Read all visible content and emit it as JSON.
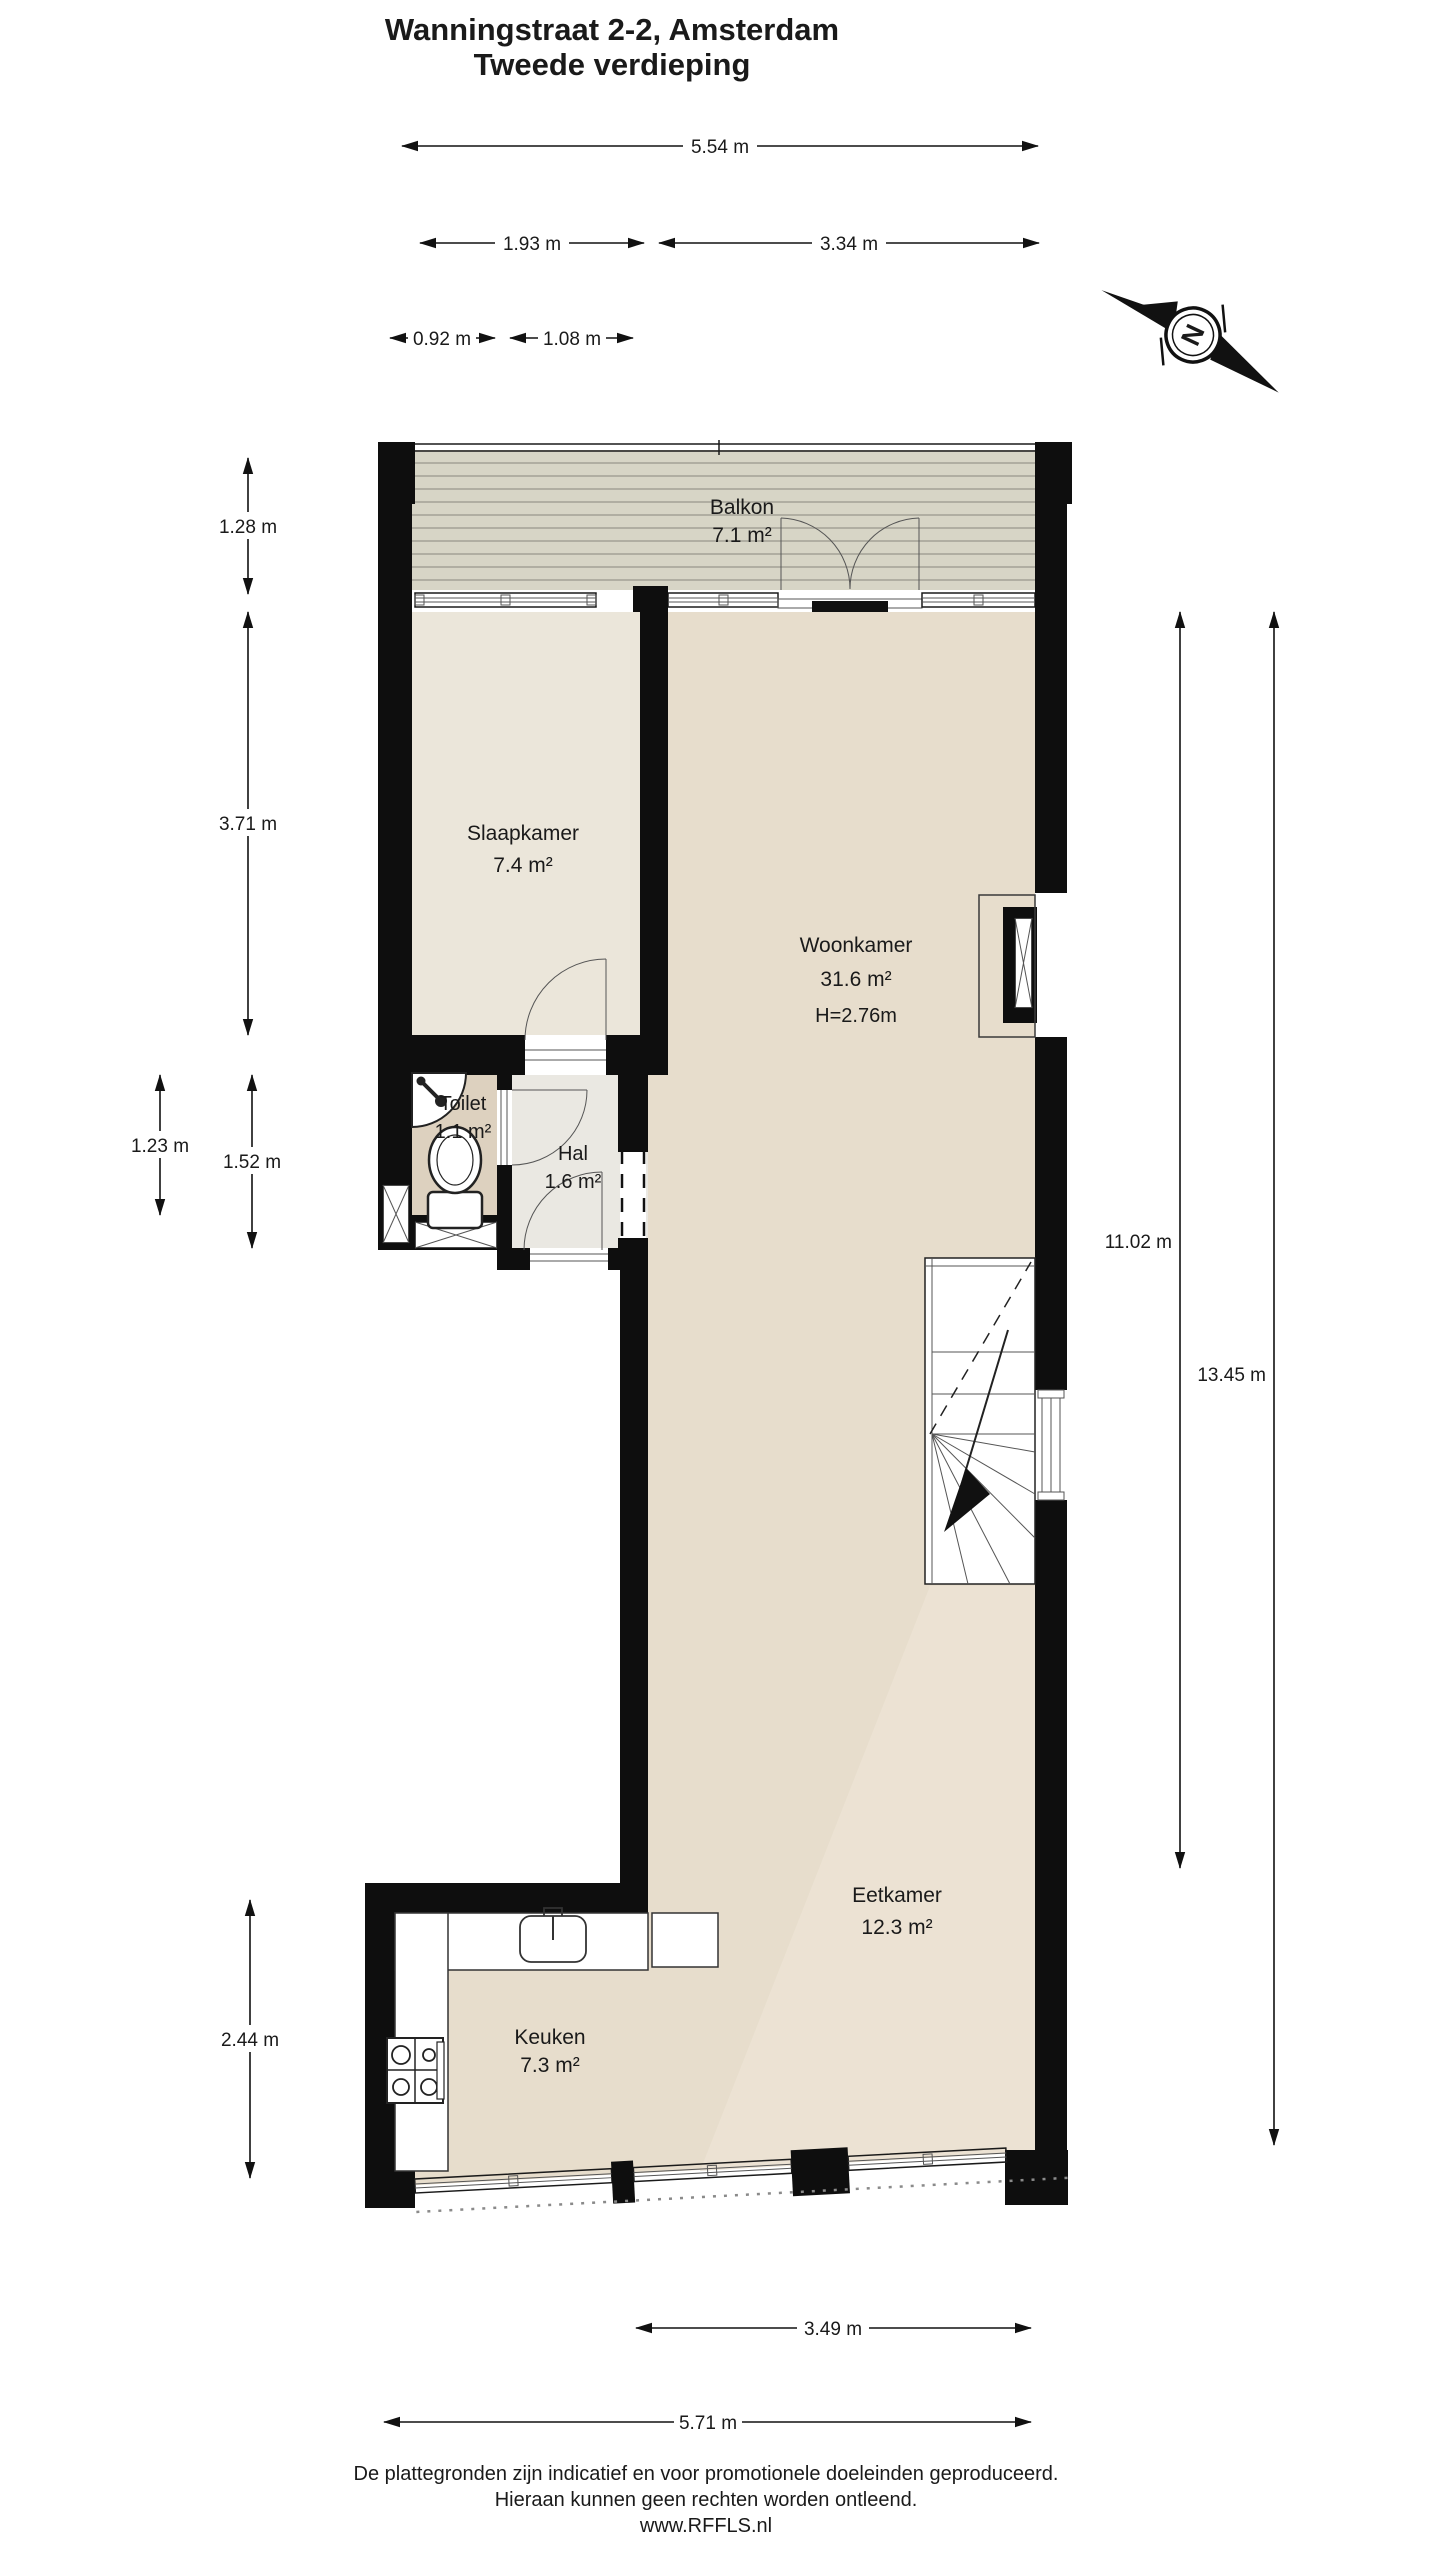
{
  "title": {
    "line1": "Wanningstraat 2-2, Amsterdam",
    "line2": "Tweede verdieping"
  },
  "rooms": {
    "balkon": {
      "name": "Balkon",
      "area": "7.1 m²"
    },
    "slaapkamer": {
      "name": "Slaapkamer",
      "area": "7.4 m²"
    },
    "woonkamer": {
      "name": "Woonkamer",
      "area": "31.6 m²",
      "ceiling_height": "H=2.76m"
    },
    "toilet": {
      "name": "Toilet",
      "area": "1.1 m²"
    },
    "hal": {
      "name": "Hal",
      "area": "1.6 m²"
    },
    "eetkamer": {
      "name": "Eetkamer",
      "area": "12.3 m²"
    },
    "keuken": {
      "name": "Keuken",
      "area": "7.3 m²"
    }
  },
  "dimensions": {
    "top_total": "5.54 m",
    "top_left": "1.93 m",
    "top_right": "3.34 m",
    "top_small_left": "0.92 m",
    "top_small_right": "1.08 m",
    "left_balcony": "1.28 m",
    "left_bedroom": "3.71 m",
    "left_toilet": "1.23 m",
    "left_hall": "1.52 m",
    "left_kitchen": "2.44 m",
    "right_inner": "11.02 m",
    "right_outer": "13.45 m",
    "bottom_inner": "3.49 m",
    "bottom_total": "5.71 m"
  },
  "compass": {
    "north_label": "N"
  },
  "footer": {
    "line1": "De plattegronden zijn indicatief en voor promotionele doeleinden geproduceerd.",
    "line2": "Hieraan kunnen geen rechten worden ontleend.",
    "line3": "www.RFFLS.nl"
  },
  "colors": {
    "wall": "#0e0e0e",
    "floor_main": "#e7ddcc",
    "floor_light": "#ece3d4",
    "bedroom": "#ebe6da",
    "toilet": "#ddd1bf",
    "hall": "#eae8e2",
    "balcony": "#d7d5c6",
    "balcony_line": "#a3a196"
  }
}
